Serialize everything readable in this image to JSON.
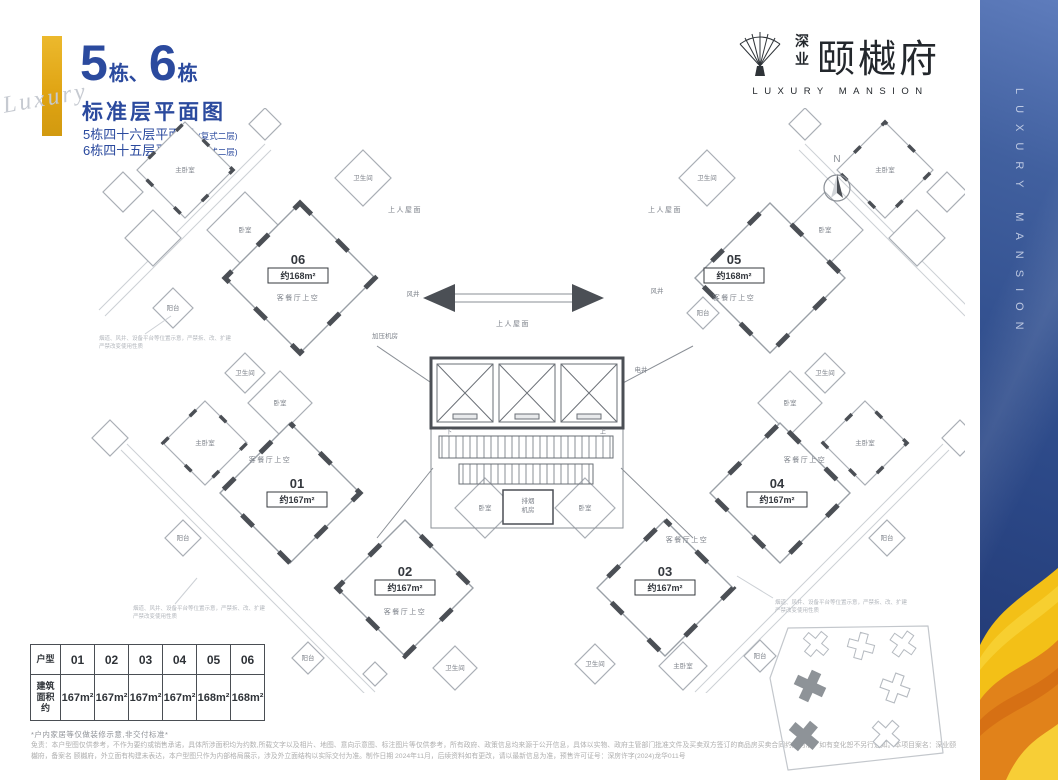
{
  "title": {
    "num1": "5",
    "suffix1": "栋、",
    "num2": "6",
    "suffix2": "栋",
    "script": "Luxury",
    "heading": "标准层平面图",
    "sub1": "5栋四十六层平面图",
    "sub1_tag": "(复式二层)",
    "sub2": "6栋四十五层平面图",
    "sub2_tag": "(复式二层)"
  },
  "logo": {
    "brand": "深业",
    "name": "颐樾府",
    "en": "LUXURY MANSION"
  },
  "compass": {
    "label": "N"
  },
  "plan": {
    "units": [
      {
        "no": "01",
        "area": "约167m²"
      },
      {
        "no": "02",
        "area": "约167m²"
      },
      {
        "no": "03",
        "area": "约167m²"
      },
      {
        "no": "04",
        "area": "约167m²"
      },
      {
        "no": "05",
        "area": "约168m²"
      },
      {
        "no": "06",
        "area": "约168m²"
      }
    ],
    "room_labels": {
      "living": "客餐厅上空",
      "balcony": "阳台",
      "master": "主卧室",
      "bed": "卧室",
      "bath": "卫生间",
      "wind_shaft": "风井",
      "elec_shaft": "电井",
      "pressure_room": "加压机房",
      "smoke_room_1": "排烟",
      "smoke_room_2": "机房",
      "roof": "上人屋面",
      "up": "上",
      "down": "下"
    },
    "annotation": {
      "line1": "烟道、风井、设备平台等位置示意，严禁拆、改、扩建",
      "line2": "严禁改变使用性质"
    }
  },
  "table": {
    "header": "户型",
    "area_header": "建筑面积约",
    "units": [
      "01",
      "02",
      "03",
      "04",
      "05",
      "06"
    ],
    "areas": [
      "167m²",
      "167m²",
      "167m²",
      "167m²",
      "168m²",
      "168m²"
    ]
  },
  "note": "*户内家居等仅做装修示意,非交付标准*",
  "disclaimer": "免责：本户型图仅供参考，不作为要约或销售承诺，具体所涉面积均为约数,所载文字以及相片、地图、意向示意图、标注图片等仅供参考，所有政府、政策信息均来源于公开信息，具体以实物、政府主管部门批准文件及买卖双方签订的商品房买卖合同约定为准，如有变化恕不另行通知。本项目案名：深业颐樾府，备案名 颐樾府，外立面有构建未表达，本户型图只作为内部格局展示，涉及外立面结构以实际交付为准。制作日期 2024年11月，后续资料如有更改，请以最新信息为准，预售许可证号：深房许字(2024)龙华011号",
  "sidebar": {
    "vertical_text": "LUXURY MANSION"
  },
  "colors": {
    "accent_blue": "#2b4a9e",
    "accent_gold": "#dfa312",
    "wall_dark": "#4b4f55",
    "banner_blue": "#32508f",
    "banner_gold": "#f3c017"
  }
}
